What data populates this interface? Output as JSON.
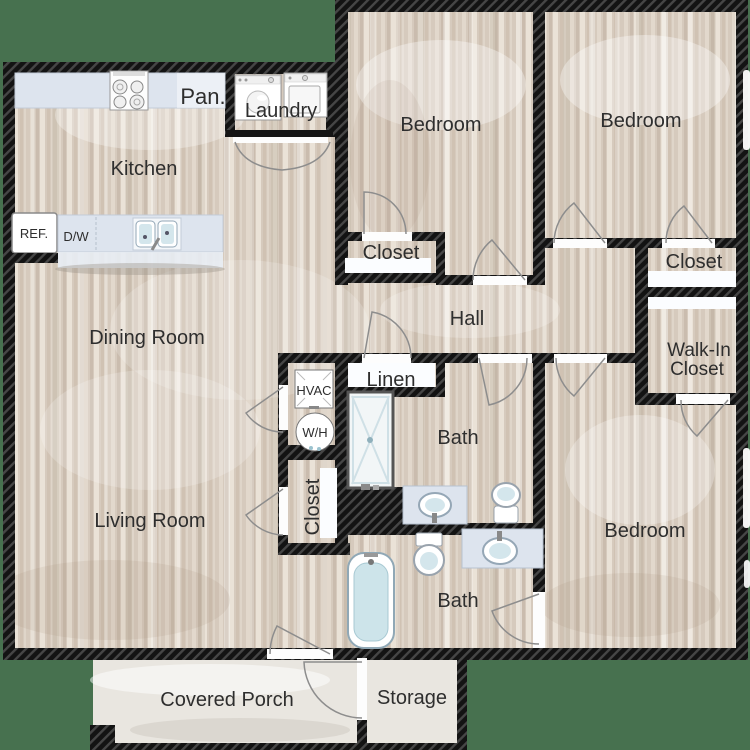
{
  "plan": {
    "background_color": "#47714f",
    "wall_color": "#131313",
    "floor_base_color": "#d6cabd",
    "counter_color": "#dde4ee",
    "fixture_accent_color": "#cfe3ea",
    "rooms": {
      "kitchen": "Kitchen",
      "pantry": "Pan.",
      "laundry": "Laundry",
      "bedroom_top_left": "Bedroom",
      "bedroom_top_right": "Bedroom",
      "bedroom_right": "Bedroom",
      "closet_bedroom_top_left": "Closet",
      "closet_bedroom_top_right": "Closet",
      "walk_in_line1": "Walk-In",
      "walk_in_line2": "Closet",
      "hall": "Hall",
      "linen": "Linen",
      "dining": "Dining Room",
      "living": "Living Room",
      "bath_upper": "Bath",
      "bath_lower": "Bath",
      "closet_living": "Closet",
      "porch": "Covered Porch",
      "storage": "Storage"
    },
    "fixtures": {
      "refrigerator": "REF.",
      "dishwasher": "D/W",
      "hvac": "HVAC",
      "water_heater": "W/H"
    }
  }
}
